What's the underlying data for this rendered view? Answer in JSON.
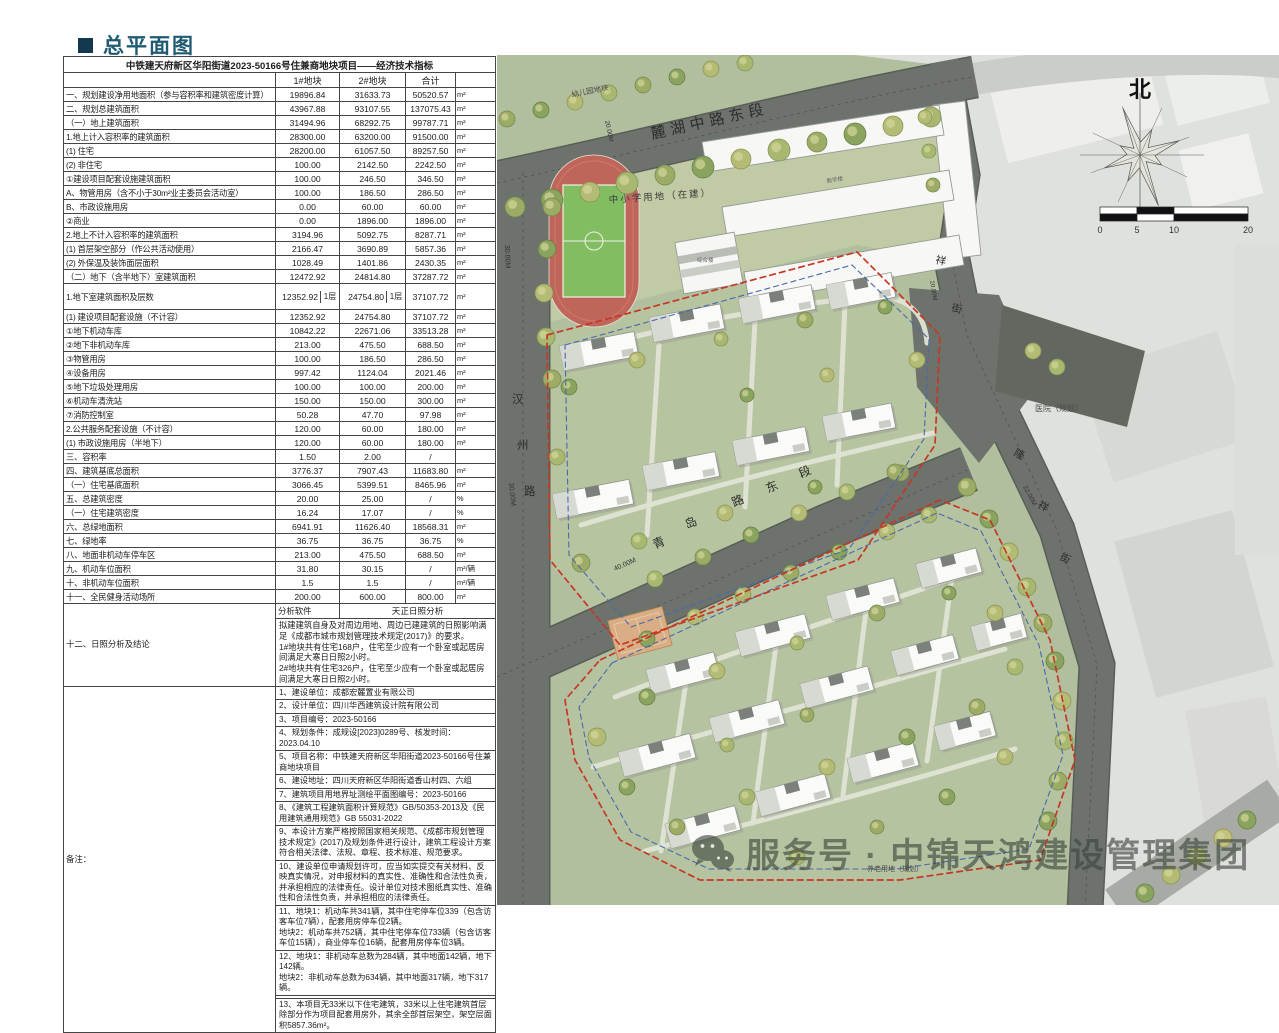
{
  "page": {
    "title": "总平面图"
  },
  "table": {
    "title": "中铁建天府新区华阳街道2023-50166号住兼商地块项目——经济技术指标",
    "columns": [
      "1#地块",
      "2#地块",
      "合计"
    ],
    "rows": [
      {
        "label": "一、规划建设净用地面积（参与容积率和建筑密度计算）",
        "v1": "19896.84",
        "v2": "31633.73",
        "total": "50520.57",
        "unit": "m²"
      },
      {
        "label": "二、规划总建筑面积",
        "v1": "43967.88",
        "v2": "93107.55",
        "total": "137075.43",
        "unit": "m²"
      },
      {
        "label": "（一）地上建筑面积",
        "v1": "31494.96",
        "v2": "68292.75",
        "total": "99787.71",
        "unit": "m²"
      },
      {
        "label": "1.地上计入容积率的建筑面积",
        "v1": "28300.00",
        "v2": "63200.00",
        "total": "91500.00",
        "unit": "m²"
      },
      {
        "label": "(1) 住宅",
        "v1": "28200.00",
        "v2": "61057.50",
        "total": "89257.50",
        "unit": "m²"
      },
      {
        "label": "(2) 非住宅",
        "v1": "100.00",
        "v2": "2142.50",
        "total": "2242.50",
        "unit": "m²"
      },
      {
        "label": "①建设项目配套设施建筑面积",
        "v1": "100.00",
        "v2": "246.50",
        "total": "346.50",
        "unit": "m²"
      },
      {
        "label": "A、物管用房（含不小于30m²业主委员会活动室）",
        "v1": "100.00",
        "v2": "186.50",
        "total": "286.50",
        "unit": "m²"
      },
      {
        "label": "B、市政设施用房",
        "v1": "0.00",
        "v2": "60.00",
        "total": "60.00",
        "unit": "m²"
      },
      {
        "label": "②商业",
        "v1": "0.00",
        "v2": "1896.00",
        "total": "1896.00",
        "unit": "m²"
      },
      {
        "label": "2.地上不计入容积率的建筑面积",
        "v1": "3194.96",
        "v2": "5092.75",
        "total": "8287.71",
        "unit": "m²"
      },
      {
        "label": "(1) 首层架空部分（作公共活动使用）",
        "v1": "2166.47",
        "v2": "3690.89",
        "total": "5857.36",
        "unit": "m²"
      },
      {
        "label": "(2) 外保温及装饰面层面积",
        "v1": "1028.49",
        "v2": "1401.86",
        "total": "2430.35",
        "unit": "m²"
      },
      {
        "label": "（二）地下（含半地下）室建筑面积",
        "v1": "12472.92",
        "v2": "24814.80",
        "total": "37287.72",
        "unit": "m²"
      },
      {
        "label": "1.地下室建筑面积及层数",
        "v1": "12352.92",
        "floors1": "1层",
        "v2": "24754.80",
        "floors2": "1层",
        "total": "37107.72",
        "unit": "m²",
        "split": true
      },
      {
        "label": "(1) 建设项目配套设施（不计容）",
        "v1": "12352.92",
        "v2": "24754.80",
        "total": "37107.72",
        "unit": "m²"
      },
      {
        "label": "①地下机动车库",
        "v1": "10842.22",
        "v2": "22671.06",
        "total": "33513.28",
        "unit": "m²"
      },
      {
        "label": "②地下非机动车库",
        "v1": "213.00",
        "v2": "475.50",
        "total": "688.50",
        "unit": "m²"
      },
      {
        "label": "③物管用房",
        "v1": "100.00",
        "v2": "186.50",
        "total": "286.50",
        "unit": "m²"
      },
      {
        "label": "④设备用房",
        "v1": "997.42",
        "v2": "1124.04",
        "total": "2021.46",
        "unit": "m²"
      },
      {
        "label": "⑤地下垃圾处理用房",
        "v1": "100.00",
        "v2": "100.00",
        "total": "200.00",
        "unit": "m²"
      },
      {
        "label": "⑥机动车清洗站",
        "v1": "150.00",
        "v2": "150.00",
        "total": "300.00",
        "unit": "m²"
      },
      {
        "label": "⑦消防控制室",
        "v1": "50.28",
        "v2": "47.70",
        "total": "97.98",
        "unit": "m²"
      },
      {
        "label": "2.公共服务配套设施（不计容）",
        "v1": "120.00",
        "v2": "60.00",
        "total": "180.00",
        "unit": "m²"
      },
      {
        "label": "(1) 市政设施用房（半地下）",
        "v1": "120.00",
        "v2": "60.00",
        "total": "180.00",
        "unit": "m²"
      },
      {
        "label": "三、容积率",
        "v1": "1.50",
        "v2": "2.00",
        "total": "/",
        "unit": ""
      },
      {
        "label": "四、建筑基底总面积",
        "v1": "3776.37",
        "v2": "7907.43",
        "total": "11683.80",
        "unit": "m²"
      },
      {
        "label": "（一）住宅基底面积",
        "v1": "3066.45",
        "v2": "5399.51",
        "total": "8465.96",
        "unit": "m²"
      },
      {
        "label": "五、总建筑密度",
        "v1": "20.00",
        "v2": "25.00",
        "total": "/",
        "unit": "%"
      },
      {
        "label": "（一）住宅建筑密度",
        "v1": "16.24",
        "v2": "17.07",
        "total": "/",
        "unit": "%"
      },
      {
        "label": "六、总绿地面积",
        "v1": "6941.91",
        "v2": "11626.40",
        "total": "18568.31",
        "unit": "m²"
      },
      {
        "label": "七、绿地率",
        "v1": "36.75",
        "v2": "36.75",
        "total": "36.75",
        "unit": "%"
      },
      {
        "label": "八、地面非机动车停车区",
        "v1": "213.00",
        "v2": "475.50",
        "total": "688.50",
        "unit": "m²"
      },
      {
        "label": "九、机动车位面积",
        "v1": "31.80",
        "v2": "30.15",
        "total": "/",
        "unit": "m²/辆"
      },
      {
        "label": "十、非机动车位面积",
        "v1": "1.5",
        "v2": "1.5",
        "total": "/",
        "unit": "m²/辆"
      },
      {
        "label": "十一、全民健身活动场所",
        "v1": "200.00",
        "v2": "600.00",
        "total": "800.00",
        "unit": "m²"
      }
    ],
    "analysis": {
      "row_label": "十二、日照分析及结论",
      "software_label": "分析软件",
      "software_value": "天正日照分析",
      "conclusions": [
        "拟建建筑自身及对周边用地、周边已建建筑的日照影响满足《成都市城市规划管理技术规定(2017)》的要求。",
        "1#地块共有住宅168户，住宅至少应有一个卧室或起居房间满足大寒日日照2小时。",
        "2#地块共有住宅326户，住宅至少应有一个卧室或起居房间满足大寒日日照2小时。"
      ]
    },
    "notes": {
      "label": "备注：",
      "items": [
        "1、建设单位：成都宏麓置业有限公司",
        "2、设计单位：四川华西建筑设计院有限公司",
        "3、项目编号：2023-50166",
        "4、规划条件：成规设[2023]0289号、核发时间：2023.04.10",
        "5、项目名称：中铁建天府新区华阳街道2023-50166号住兼商地块项目",
        "6、建设地址：四川天府新区华阳街道香山村四、六组",
        "7、建筑项目用地界址测绘平面图编号：2023-50166",
        "8、《建筑工程建筑面积计算规范》GB/50353-2013及《民用建筑通用规范》GB 55031-2022",
        "9、本设计方案严格按照国家相关规范、《成都市规划管理技术规定》(2017)及规划条件进行设计，建筑工程设计方案符合相关法律、法规、章程、技术标准、规范要求。",
        "10、建设单位申请规划许可，应当如实提交有关材料、反映真实情况，对申报材料的真实性、准确性和合法性负责，并承担相应的法律责任。设计单位对技术图纸真实性、准确性和合法性负责，并承担相应的法律责任。",
        "11、地块1：机动车共341辆，其中住宅停车位339（包含访客车位7辆），配套用房停车位2辆。\n地块2：机动车共752辆，其中住宅停车位733辆（包含访客车位15辆），商业停车位16辆，配套用房停车位3辆。",
        "12、地块1：非机动车总数为284辆，其中地面142辆，地下142辆。\n地块2：非机动车总数为634辆，其中地面317辆，地下317辆。",
        "",
        "13、本项目无33米以下住宅建筑，33米以上住宅建筑首层除部分作为项目配套用房外，其余全部首层架空，架空层面积5857.36m²。"
      ]
    }
  },
  "map": {
    "north_label": "北",
    "scale_ticks": [
      "0",
      "5",
      "10",
      "20"
    ],
    "road_names": {
      "north_road": "麓湖中路东段",
      "west_road": "汉州路",
      "middle_road": "青岛路东段",
      "northeast_road": "祥街",
      "east_road": "隆祥街"
    },
    "road_widths": {
      "west_road": "30.00M",
      "west_road_2": "30.00M",
      "north_road": "20.00M",
      "middle_road": "40.00M",
      "east_road": "22.00M",
      "northeast_road": "20.00M"
    },
    "area_labels": {
      "kindergarten": "幼儿园地块",
      "school": "中小学用地（在建）",
      "hospital": "医院（规划）",
      "elderly_care": "养老用地（规划）",
      "school_building_a": "教学楼",
      "school_building_b": "综合楼"
    },
    "watermark": {
      "text": "服务号 · 中锦天鸿建设管理集团"
    },
    "colors": {
      "parcel_boundary": "#c63726",
      "garage_boundary": "#4a68ac",
      "road": "#6d726d",
      "greenland": "#b2bf9e",
      "track_red": "#c0655a",
      "field_green": "#82bd62"
    }
  }
}
